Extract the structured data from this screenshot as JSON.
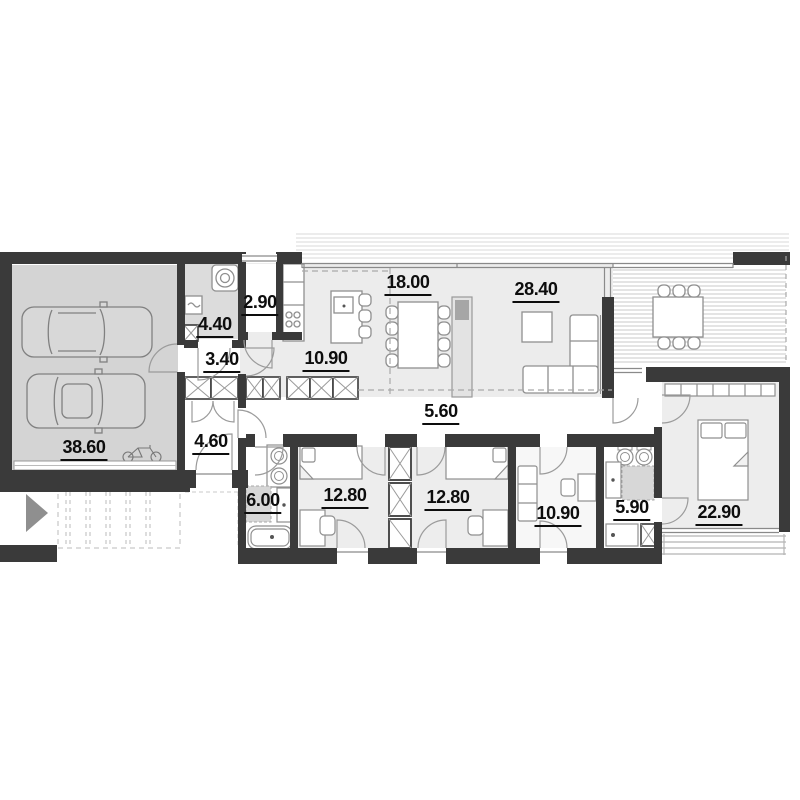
{
  "plan": {
    "type": "single-storey house floor plan",
    "rooms": [
      {
        "id": "garage",
        "area": "38.60"
      },
      {
        "id": "utility",
        "area": "4.40"
      },
      {
        "id": "pantry",
        "area": "2.90"
      },
      {
        "id": "vestibule",
        "area": "3.40"
      },
      {
        "id": "kitchen",
        "area": "10.90"
      },
      {
        "id": "dining",
        "area": "18.00"
      },
      {
        "id": "living",
        "area": "28.40"
      },
      {
        "id": "entry-hall",
        "area": "4.60"
      },
      {
        "id": "corridor",
        "area": "5.60"
      },
      {
        "id": "bathroom",
        "area": "6.00"
      },
      {
        "id": "bedroom-1",
        "area": "12.80"
      },
      {
        "id": "bedroom-2",
        "area": "12.80"
      },
      {
        "id": "study",
        "area": "10.90"
      },
      {
        "id": "bathroom-2",
        "area": "5.90"
      },
      {
        "id": "master-bedroom",
        "area": "22.90"
      }
    ],
    "colors": {
      "wall": "#3a3a3a",
      "garage_floor": "#d4d4d4",
      "utility_floor": "#dcdcdc",
      "open_plan_floor": "#ececec",
      "bedroom_floor": "#ededed",
      "shower_gray": "#d7d7d7",
      "arrow_gray": "#8f8f8f"
    }
  }
}
